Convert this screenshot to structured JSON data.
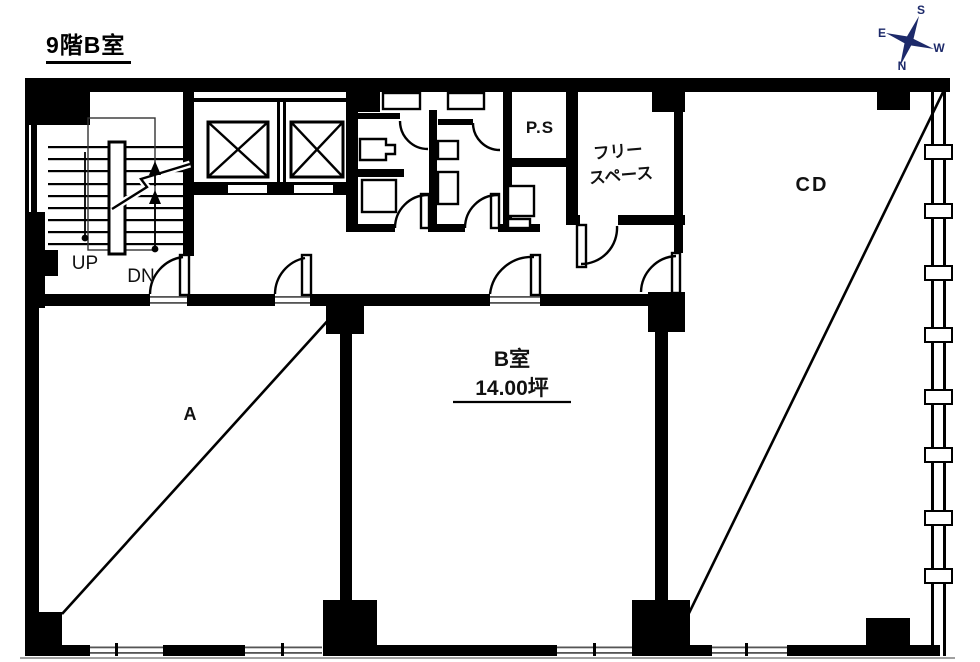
{
  "title": "9階B室",
  "compass": {
    "s": "S",
    "e": "E",
    "w": "W",
    "n": "N",
    "color": "#1d2a6a"
  },
  "stairs": {
    "up": "UP",
    "dn": "DN"
  },
  "labels": {
    "ps": "P.S",
    "free_space_1": "フリー",
    "free_space_2": "スペース",
    "cd": "CD",
    "a": "A",
    "b_name": "B室",
    "b_area": "14.00坪"
  },
  "colors": {
    "wall": "#000000",
    "background": "#ffffff",
    "ground_line": "#a0a0a0"
  }
}
